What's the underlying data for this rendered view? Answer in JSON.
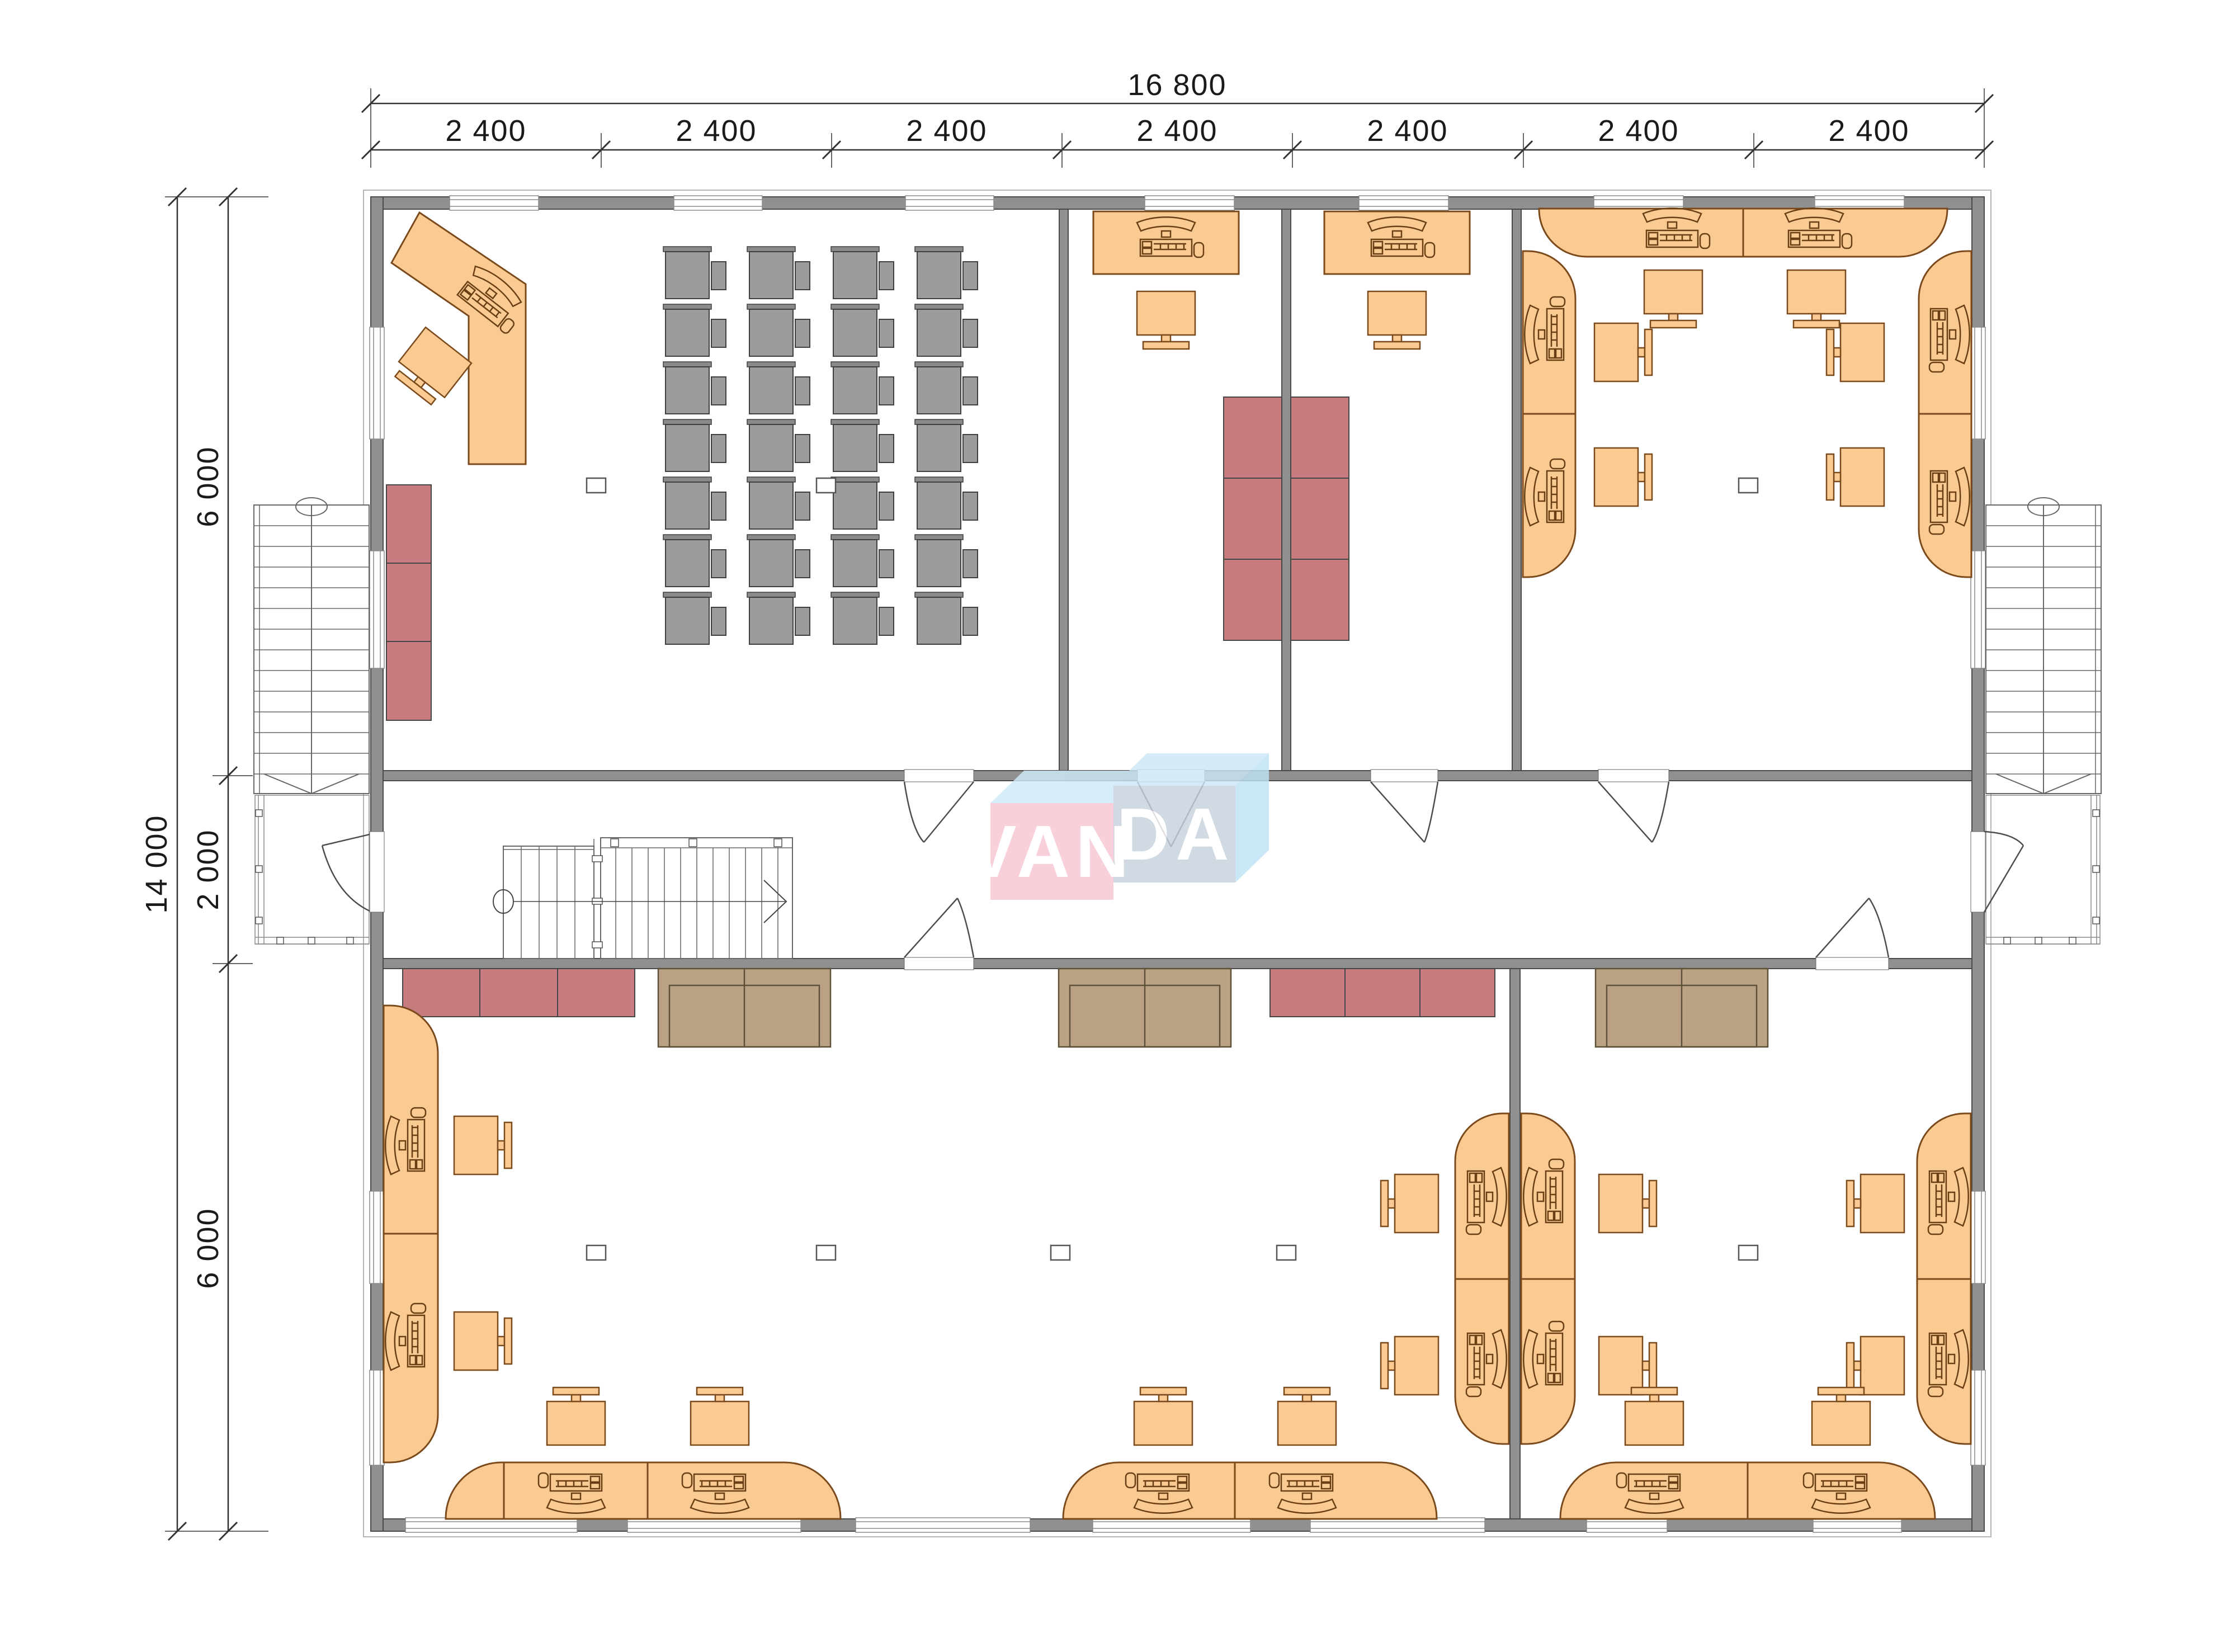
{
  "title": "VANDA two-storey office building — upper floor plan",
  "logo": {
    "van": "VAN",
    "da": "DA"
  },
  "dimensions": {
    "total_width": "16 800",
    "top_segments": [
      "2 400",
      "2 400",
      "2 400",
      "2 400",
      "2 400",
      "2 400",
      "2 400"
    ],
    "total_height": "14 000",
    "left_segments": [
      "6 000",
      "2 000",
      "6 000"
    ]
  },
  "colors": {
    "wall_gray": "#909090",
    "wall_outline": "#4a4a4a",
    "desk_orange": "#F9CA92",
    "desk_outline": "#7a4a1c",
    "classroom_gray": "#9c9c9c",
    "sofa_red": "#C77C80",
    "sofa_tan": "#BCA284",
    "logo_pink": "#F7C6D1",
    "logo_light_blue": "#CEEBF8",
    "logo_blue_gray": "#C8D1DE",
    "dimension_ink": "#1a1a1a"
  },
  "icons": [
    "workstation-icon",
    "chair-icon",
    "classroom-desk-unit-icon",
    "stair-direction-ellipse-icon",
    "stair-direction-arrow-icon",
    "door-swing-icon",
    "column-marker-icon"
  ]
}
